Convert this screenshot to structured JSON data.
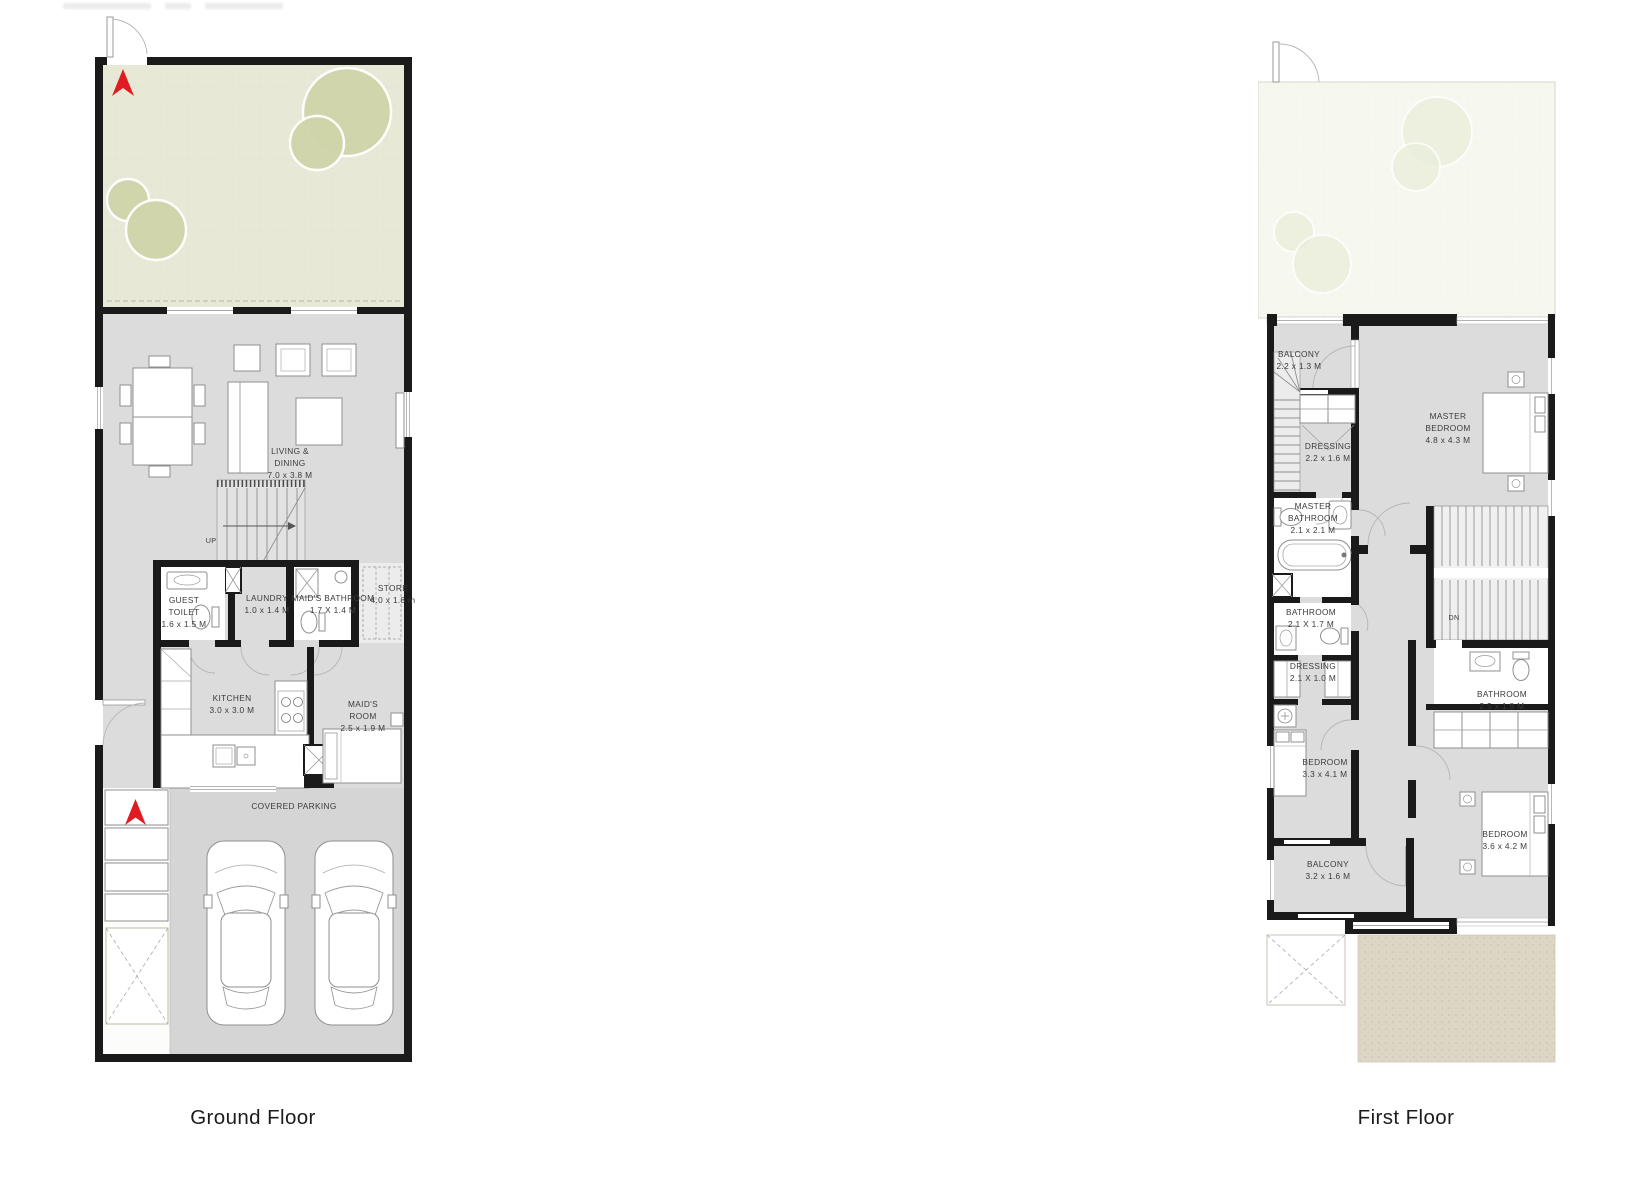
{
  "ground_floor": {
    "title": "Ground Floor",
    "rooms": {
      "living_dining": "LIVING &\nDINING\n7.0 x 3.8 M",
      "up": "UP",
      "guest_toilet": "GUEST\nTOILET\n1.6 x 1.5 M",
      "laundry": "LAUNDRY\n1.0 x 1.4 M",
      "maids_bathroom": "MAID'S BATHROOM\n1.7 X 1.4 M",
      "store": "STORE\n4.0 x 1.8 m",
      "kitchen": "KITCHEN\n3.0 x 3.0 M",
      "maids_room": "MAID'S\nROOM\n2.5 x 1.9 M",
      "covered_parking": "COVERED PARKING"
    }
  },
  "first_floor": {
    "title": "First Floor",
    "rooms": {
      "balcony_top": "BALCONY\n2.2 x 1.3 M",
      "master_bedroom": "MASTER\nBEDROOM\n4.8 x 4.3 M",
      "dressing_master": "DRESSING\n2.2 x 1.6 M",
      "master_bathroom": "MASTER\nBATHROOM\n2.1 x 2.1 M",
      "bathroom_2": "BATHROOM\n2.1 X 1.7 M",
      "dressing_2": "DRESSING\n2.1 X 1.0 M",
      "bedroom_2": "BEDROOM\n3.3 x 4.1 M",
      "balcony_bottom": "BALCONY\n3.2 x 1.6 M",
      "dn": "DN",
      "bathroom_3": "BATHROOM\n2.5 x 1.8 M",
      "bedroom_3": "BEDROOM\n3.6 x 4.2 M"
    }
  },
  "colors": {
    "wall": "#1a1a1a",
    "room_gray": "#dcdcdc",
    "parking_gray": "#d5d5d5",
    "garden_green": "#e7e9d6",
    "tree_green": "#cfd4a9",
    "first_garden": "#f6f7ee",
    "sand": "#ddd6c5",
    "arrow_red": "#e01b22"
  }
}
